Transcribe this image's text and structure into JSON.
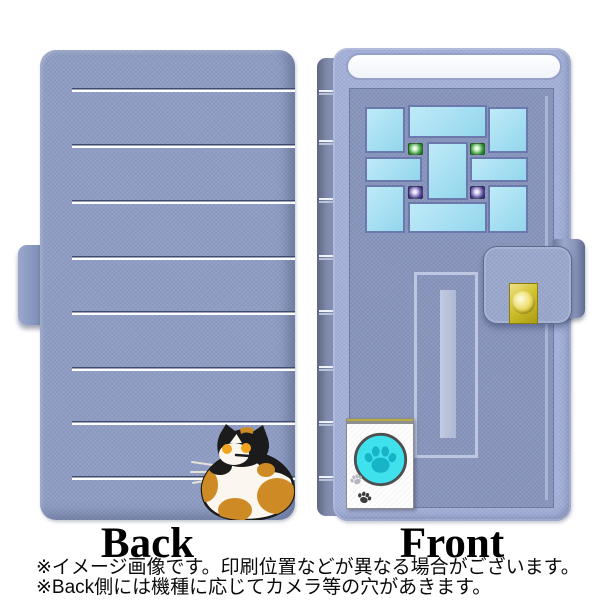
{
  "image_type": "flip-smartphone-case product illustration, back and front views",
  "views": {
    "back": {
      "label": "Back",
      "design": "periwinkle cover, 8 white horizontal stripes, calico cat at bottom right, clasp tab on left edge",
      "stripe_count": 8
    },
    "front": {
      "label": "Front",
      "design": "door motif: stained-glass window grid, vertical handle slot, clasp flap with gold knob, paw-print intercom box"
    }
  },
  "footnotes": {
    "line1": "※イメージ画像です。印刷位置などが異なる場合がございます。",
    "line2": "※Back側には機種に応じてカメラ等の穴があきます。"
  },
  "colors": {
    "case_base": "#8e9cc3",
    "cover_edge": "#a4b0d8",
    "door_panel": "#8794bb",
    "window_pane": "#a6dff2",
    "green_lamp": "#2f9135",
    "purple_lamp": "#4b3f92",
    "gold_knob": "#d9c931",
    "intercom_cyan": "#3fe2ec",
    "paw_cyan": "#17b4c8",
    "cat_orange": "#ce8b25",
    "stripe_white": "#ffffff",
    "stripe_shadow": "#3e4a6b"
  }
}
